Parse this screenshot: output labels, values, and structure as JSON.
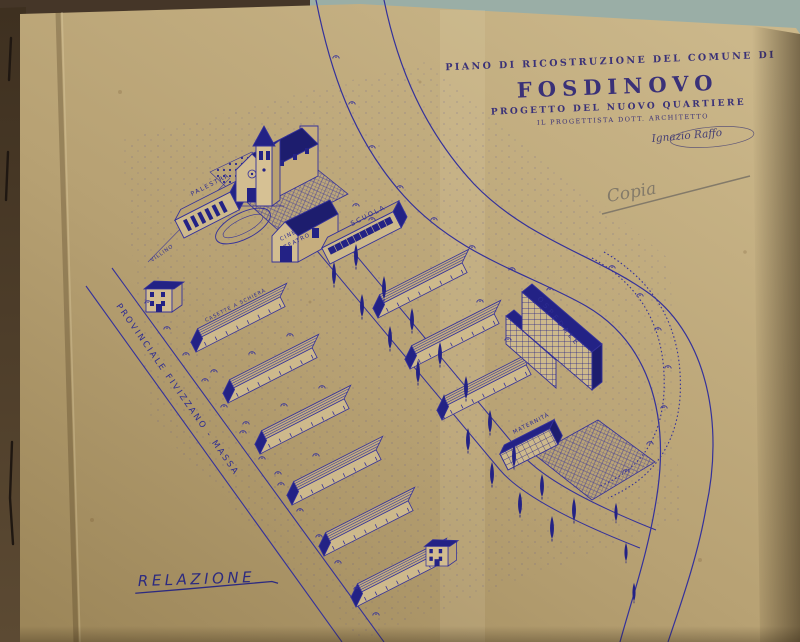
{
  "header": {
    "line1": "PIANO DI RICOSTRUZIONE DEL COMUNE DI",
    "title": "FOSDINOVO",
    "line3": "PROGETTO DEL NUOVO QUARTIERE",
    "line4": "IL PROGETTISTA DOTT. ARCHITETTO",
    "signature": "Ignazio Raffo"
  },
  "annotations": {
    "copia": "Copia",
    "relazione": "RELAZIONE"
  },
  "plan_labels": {
    "palestra": "PALESTRA",
    "cine": "CINE",
    "teatro": "TEATRO",
    "scuola": "SCUOLA",
    "villino": "VILLINO",
    "casette": "CASETTE A SCHIERA",
    "ospedale": "OSPEDALE",
    "maternita": "MATERNITÀ",
    "road": "PROVINCIALE FIVIZZANO - MASSA"
  },
  "colors": {
    "ink": "#34319b",
    "ink_dark": "#232285",
    "title_ink": "#3a3178",
    "pencil": "#837a69",
    "paper": "#b7a173",
    "paper_light": "#cdb98c",
    "cover": "#4f3d2a",
    "backdrop": "#9aaea6"
  }
}
